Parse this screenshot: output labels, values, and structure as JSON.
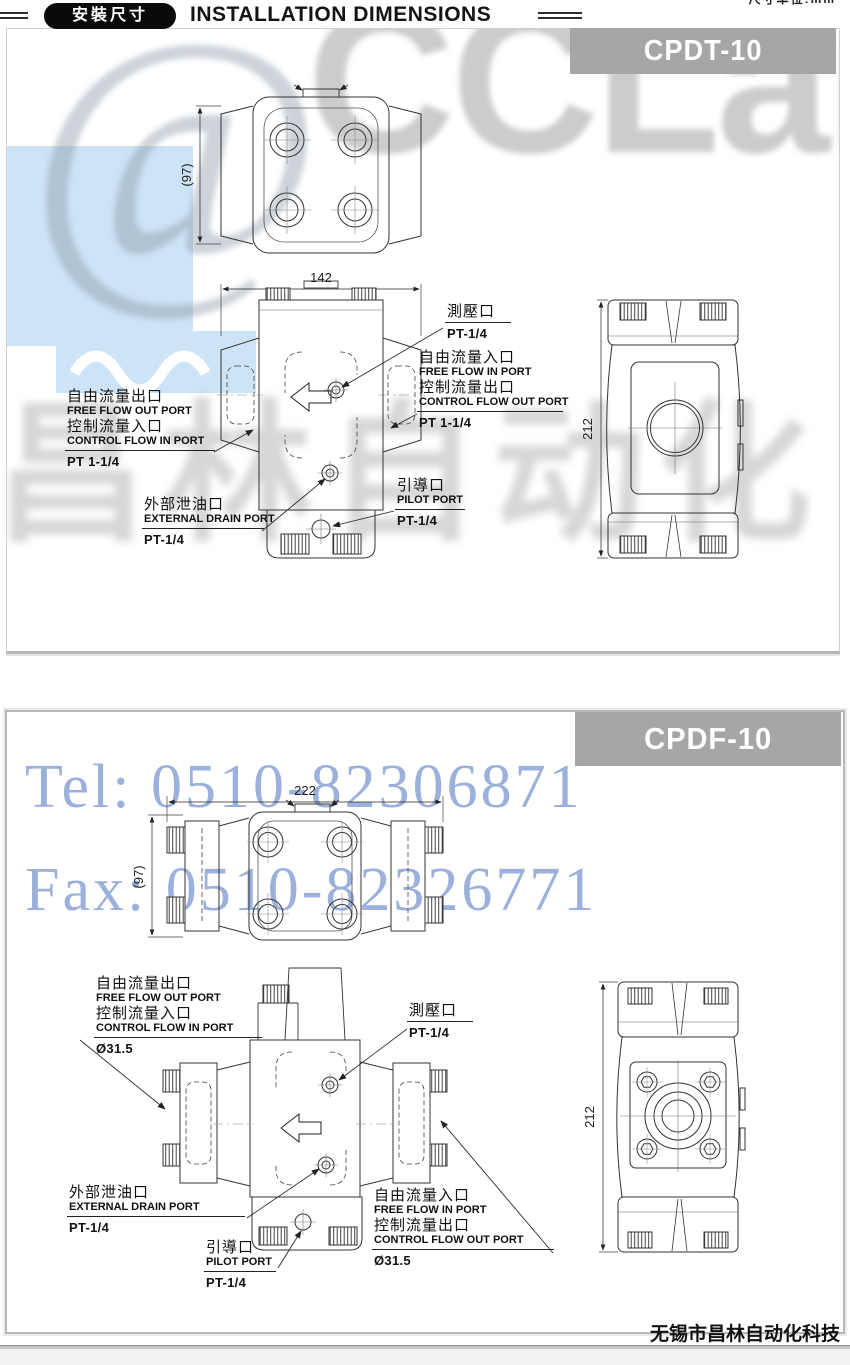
{
  "header": {
    "badge": "安裝尺寸",
    "title": "INSTALLATION DIMENSIONS",
    "unit_note": "尺寸单位:mm"
  },
  "watermark": {
    "logo_at": "@",
    "logo_text": "CCLair",
    "brand_cn": "昌林自动化",
    "tel": "Tel: 0510-82306871",
    "fax": "Fax: 0510-82326771",
    "accent_blue": "#cde3f6",
    "text_blue": "#8ba3d6"
  },
  "panel1": {
    "model": "CPDT-10",
    "dim_width": "142",
    "dim_depth": "(97)",
    "dim_height": "212",
    "labels": {
      "gauge_cn": "測壓口",
      "gauge_size": "PT-1/4",
      "free_in_cn": "自由流量入口",
      "free_in_en": "FREE FLOW IN PORT",
      "ctrl_out_cn": "控制流量出口",
      "ctrl_out_en": "CONTROL FLOW OUT PORT",
      "right_size": "PT 1-1/4",
      "free_out_cn": "自由流量出口",
      "free_out_en": "FREE FLOW OUT PORT",
      "ctrl_in_cn": "控制流量入口",
      "ctrl_in_en": "CONTROL FLOW IN PORT",
      "left_size": "PT 1-1/4",
      "drain_cn": "外部泄油口",
      "drain_en": "EXTERNAL DRAIN PORT",
      "drain_size": "PT-1/4",
      "pilot_cn": "引導口",
      "pilot_en": "PILOT PORT",
      "pilot_size": "PT-1/4"
    }
  },
  "panel2": {
    "model": "CPDF-10",
    "dim_width": "222",
    "dim_depth": "(97)",
    "dim_height": "212",
    "labels": {
      "gauge_cn": "測壓口",
      "gauge_size": "PT-1/4",
      "free_in_cn": "自由流量入口",
      "free_in_en": "FREE FLOW IN PORT",
      "ctrl_out_cn": "控制流量出口",
      "ctrl_out_en": "CONTROL FLOW OUT PORT",
      "right_size": "Ø31.5",
      "free_out_cn": "自由流量出口",
      "free_out_en": "FREE FLOW OUT PORT",
      "ctrl_in_cn": "控制流量入口",
      "ctrl_in_en": "CONTROL FLOW IN PORT",
      "left_size": "Ø31.5",
      "drain_cn": "外部泄油口",
      "drain_en": "EXTERNAL DRAIN PORT",
      "drain_size": "PT-1/4",
      "pilot_cn": "引導口",
      "pilot_en": "PILOT PORT",
      "pilot_size": "PT-1/4"
    }
  },
  "footer": {
    "company": "无锡市昌林自动化科技"
  }
}
